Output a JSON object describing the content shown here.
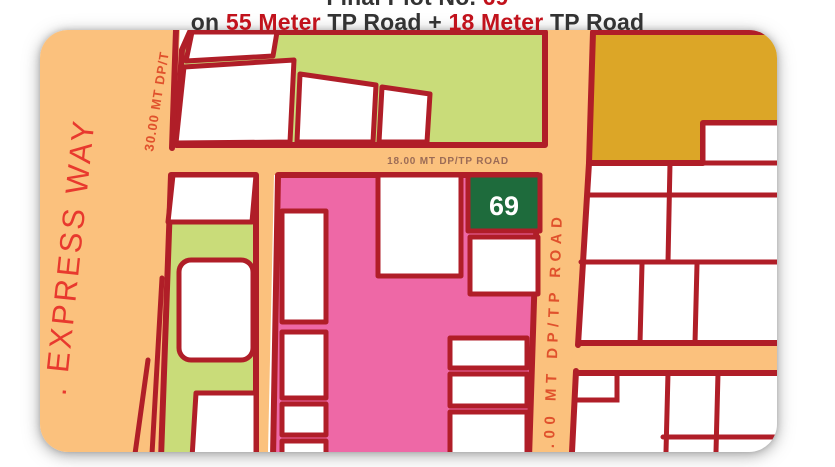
{
  "title": {
    "line1": {
      "prefix": "Final Plot No. ",
      "number": "69"
    },
    "line2": {
      "p1": "on ",
      "hl1": "55 Meter",
      "p2": " TP Road + ",
      "hl2": "18 Meter",
      "p3": " TP Road"
    }
  },
  "map": {
    "labels": {
      "express_way": ". EXPRESS WAY",
      "road_30": "30.00 MT DP/T",
      "road_18": "18.00 MT DP/TP ROAD",
      "road_55": ".00 MT DP/TP ROAD",
      "plot_69": "69"
    }
  },
  "colors": {
    "page-bg": "#FFFFFF",
    "road-orange": "#FBC17D",
    "border-red": "#B01E28",
    "light-green": "#C9DC79",
    "pink": "#EE68A6",
    "plot-green": "#1E6B3C",
    "mustard": "#DCA627",
    "plot-white": "#FFFFFF",
    "title-dark": "#333333",
    "title-red": "#C1121C",
    "label-red": "#E0512C",
    "express-red": "#E8392E",
    "road18-label": "#9B6B56"
  }
}
